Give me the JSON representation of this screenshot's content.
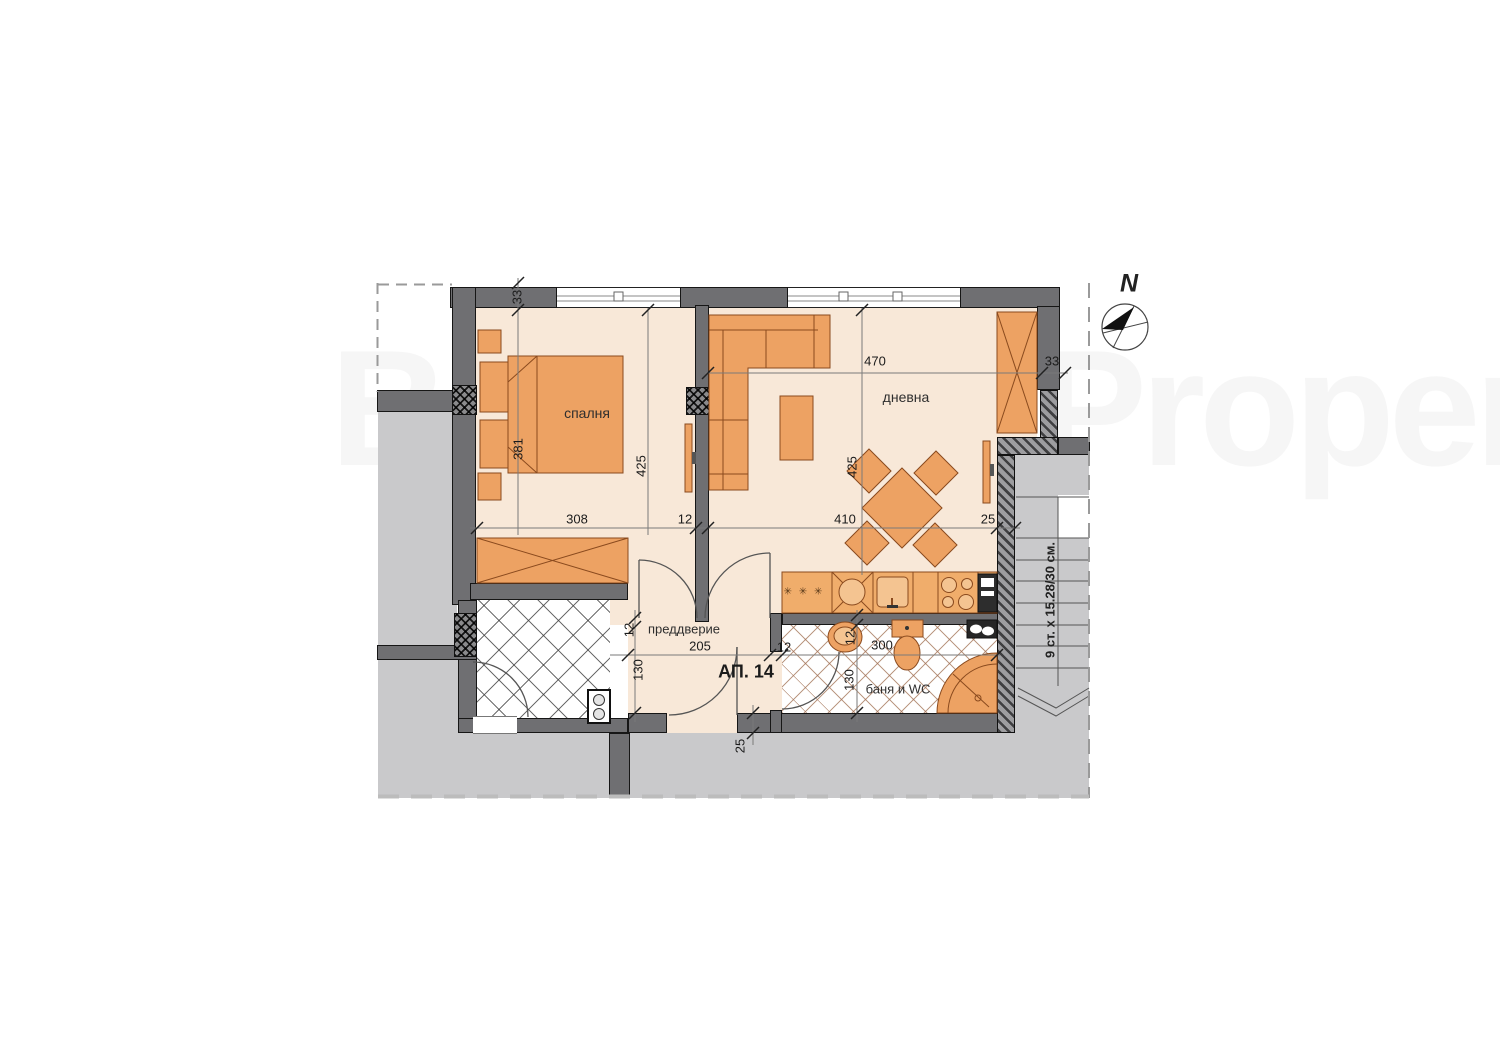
{
  "watermark": "BulgarianProperties",
  "apartment_label": "АП. 14",
  "rooms": {
    "bedroom": "спалня",
    "living_room": "дневна",
    "entrance_hall": "преддверие",
    "bathroom": "баня и WC"
  },
  "kitchen": {
    "hob_marks": "✳ ✳ ✳"
  },
  "stairs_label": "9 ст. x 15.28/30 см.",
  "compass_north": "N",
  "dimensions": {
    "top_left_wall": "33",
    "bedroom_bed_side": "381",
    "bedroom_depth": "425",
    "bedroom_width": "308",
    "partition_thickness": "12",
    "living_top_width": "470",
    "top_right_wall": "33",
    "living_depth": "425",
    "living_width": "410",
    "kitchen_wall": "25",
    "hall_wall": "12",
    "hall_width": "205",
    "hall_depth": "130",
    "bath_door_wall": "12",
    "bath_wall": "12",
    "bath_width": "300",
    "bath_depth": "130",
    "bottom_wall": "25"
  },
  "colors": {
    "furniture": "#eda263",
    "walls": "#6f6f72",
    "floor": "#f8e8d8",
    "outside": "#c9c9cb"
  }
}
